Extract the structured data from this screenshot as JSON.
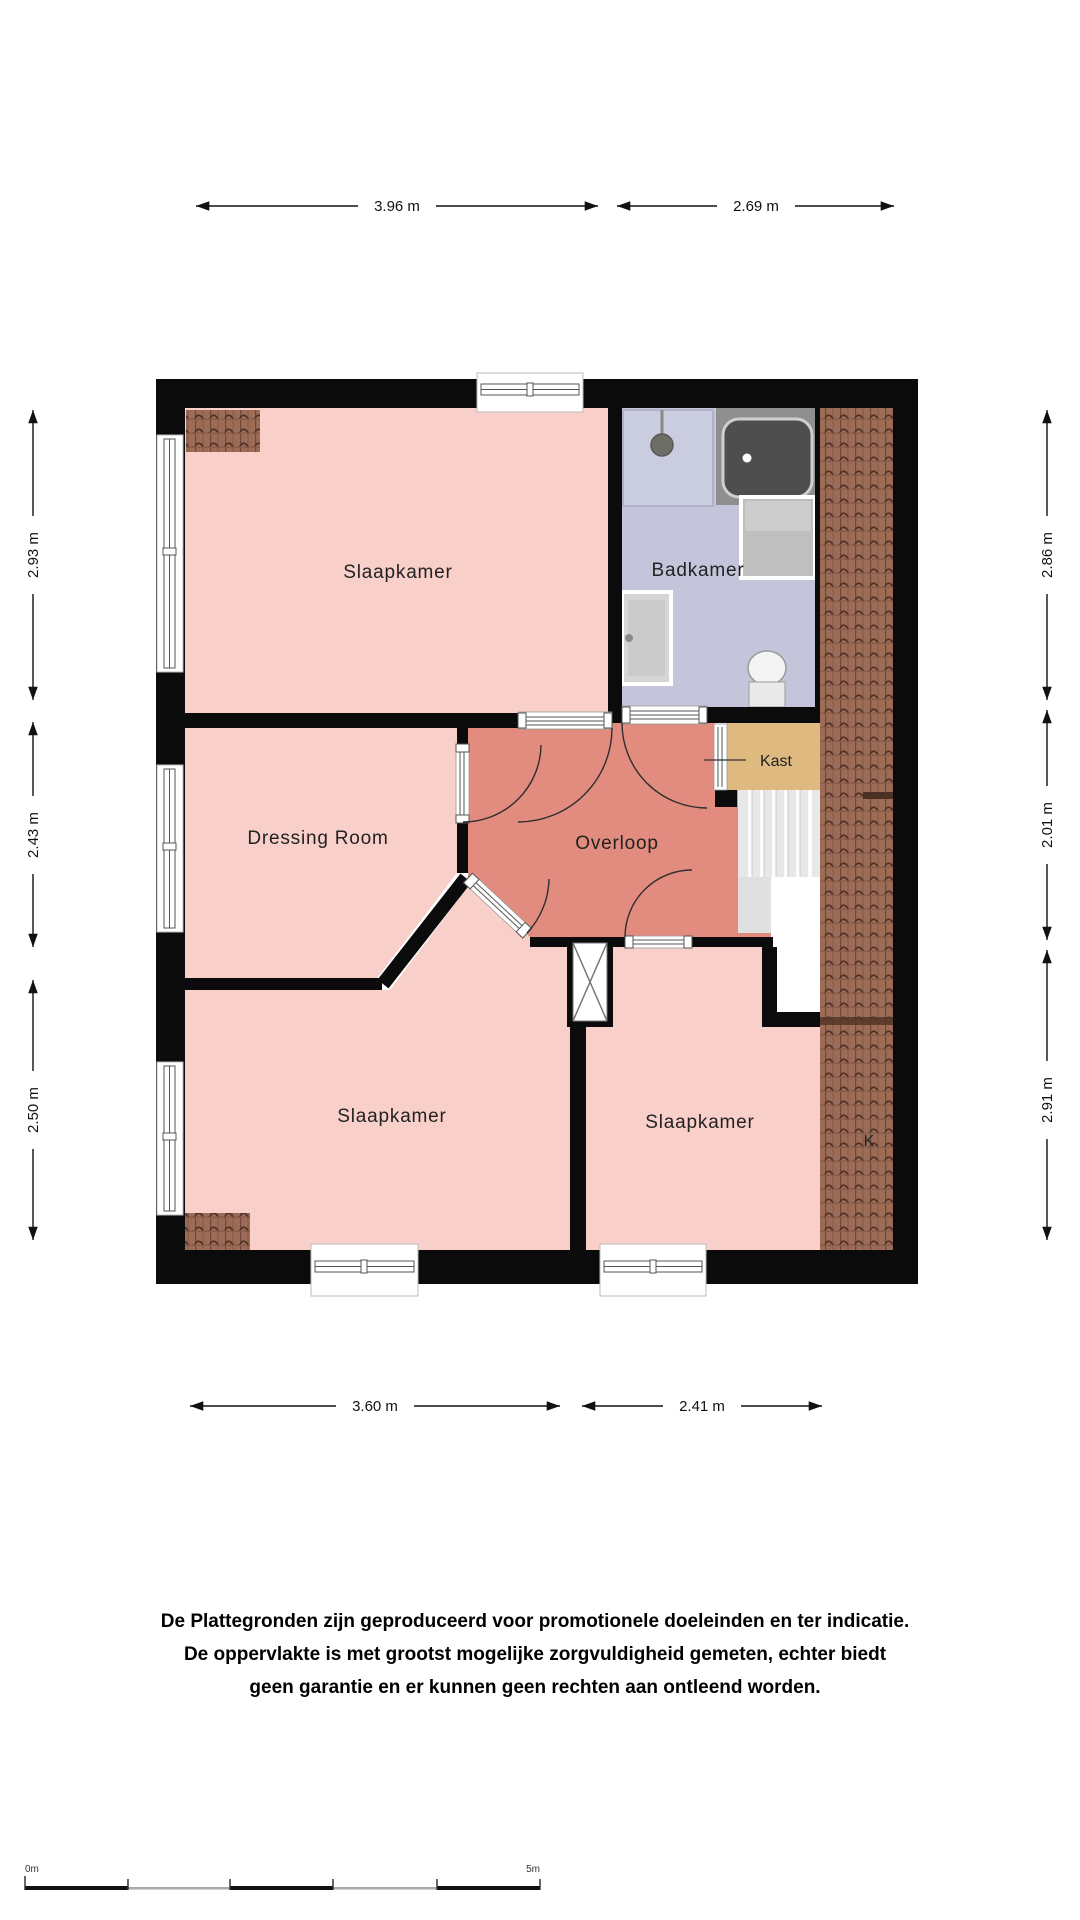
{
  "plan": {
    "rooms": {
      "slaapkamer_top": "Slaapkamer",
      "badkamer": "Badkamer",
      "dressing_room": "Dressing Room",
      "overloop": "Overloop",
      "kast": "Kast",
      "slaapkamer_bottom_left": "Slaapkamer",
      "slaapkamer_bottom_right": "Slaapkamer",
      "k_marker": "K"
    },
    "dimensions": {
      "top_left_width": "3.96 m",
      "top_right_width": "2.69 m",
      "bottom_left_width": "3.60 m",
      "bottom_right_width": "2.41 m",
      "left_top": "2.93 m",
      "left_middle": "2.43 m",
      "left_bottom": "2.50 m",
      "right_top": "2.86 m",
      "right_middle": "2.01 m",
      "right_bottom": "2.91 m"
    },
    "colors": {
      "room_pink": "#f9cfca",
      "hall_salmon": "#e28c7f",
      "bathroom_lavender": "#c4c5da",
      "shower_tray": "#caccdf",
      "closet_tan": "#dfba80",
      "roof_tile_brown": "#9c6c56",
      "wall": "#0b0b0b"
    }
  },
  "disclaimer": {
    "line1": "De Plattegronden zijn geproduceerd voor promotionele doeleinden en ter indicatie.",
    "line2": "De oppervlakte is met grootst mogelijke zorgvuldigheid gemeten, echter biedt",
    "line3": "geen garantie en er kunnen geen rechten aan ontleend worden."
  },
  "scale_bar": {
    "start_label": "0m",
    "end_label": "5m"
  }
}
